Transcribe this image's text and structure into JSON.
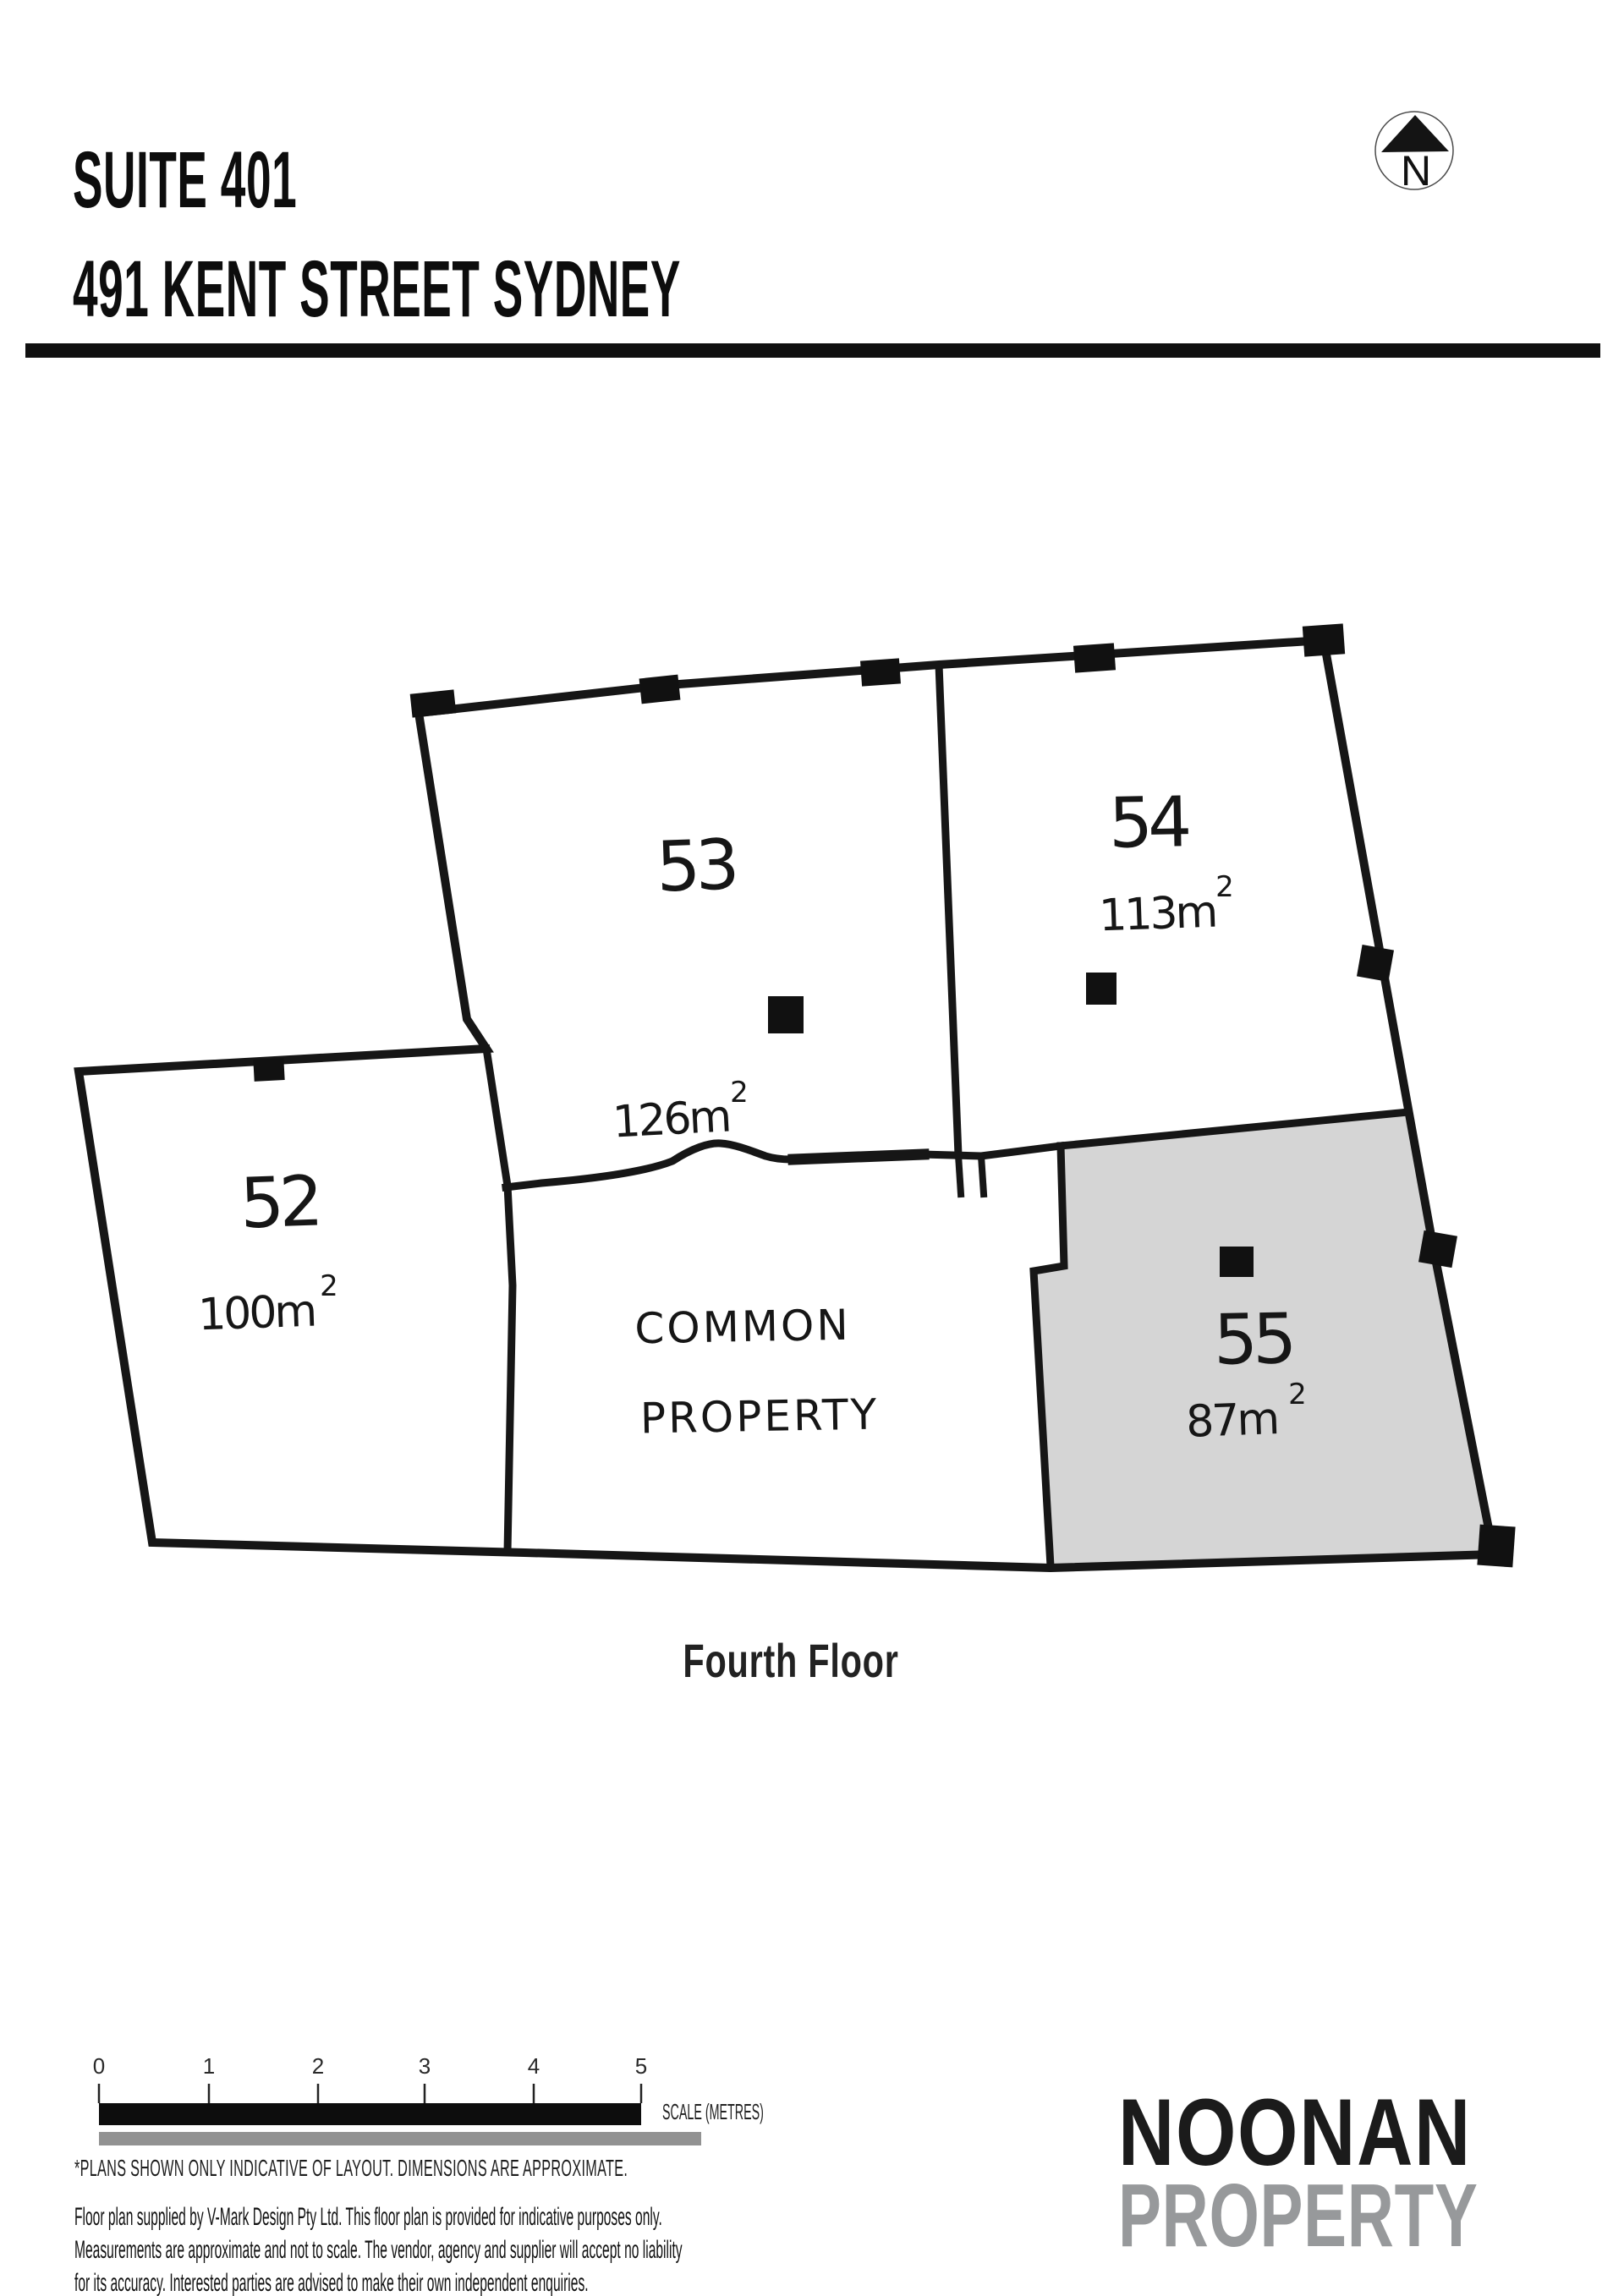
{
  "header": {
    "title_line1": "SUITE 401",
    "title_line2": "491 KENT STREET SYDNEY"
  },
  "north_arrow": {
    "label": "N"
  },
  "floor_plan": {
    "highlighted_room": "55",
    "rooms": [
      {
        "number": "53",
        "area": "126m",
        "area_sup": "2"
      },
      {
        "number": "54",
        "area": "113m",
        "area_sup": "2"
      },
      {
        "number": "52",
        "area": "100m",
        "area_sup": "2"
      },
      {
        "number": "55",
        "area": "87m",
        "area_sup": "2"
      }
    ],
    "common": {
      "line1": "COMMON",
      "line2": "PROPERTY"
    }
  },
  "floor_label": "Fourth Floor",
  "scale_bar": {
    "ticks": [
      "0",
      "1",
      "2",
      "3",
      "4",
      "5"
    ],
    "label": "SCALE (METRES)"
  },
  "disclaimer": {
    "heading": "*PLANS SHOWN ONLY INDICATIVE OF LAYOUT. DIMENSIONS ARE APPROXIMATE.",
    "line1": "Floor plan supplied by V-Mark Design Pty Ltd. This floor plan is provided for indicative purposes only.",
    "line2": "Measurements are approximate and not to scale. The vendor, agency and supplier will accept no liability",
    "line3": "for its accuracy. Interested parties are advised to make their own independent enquiries."
  },
  "logo": {
    "line1": "NOONAN",
    "line2": "PROPERTY"
  },
  "colors": {
    "wall": "#161616",
    "room55_fill": "#d5d5d5",
    "logo_gray": "#97999b",
    "scale_bar_black": "#0d0d0d",
    "scale_bar_gray": "#929292",
    "text": "#1a1a1a"
  }
}
